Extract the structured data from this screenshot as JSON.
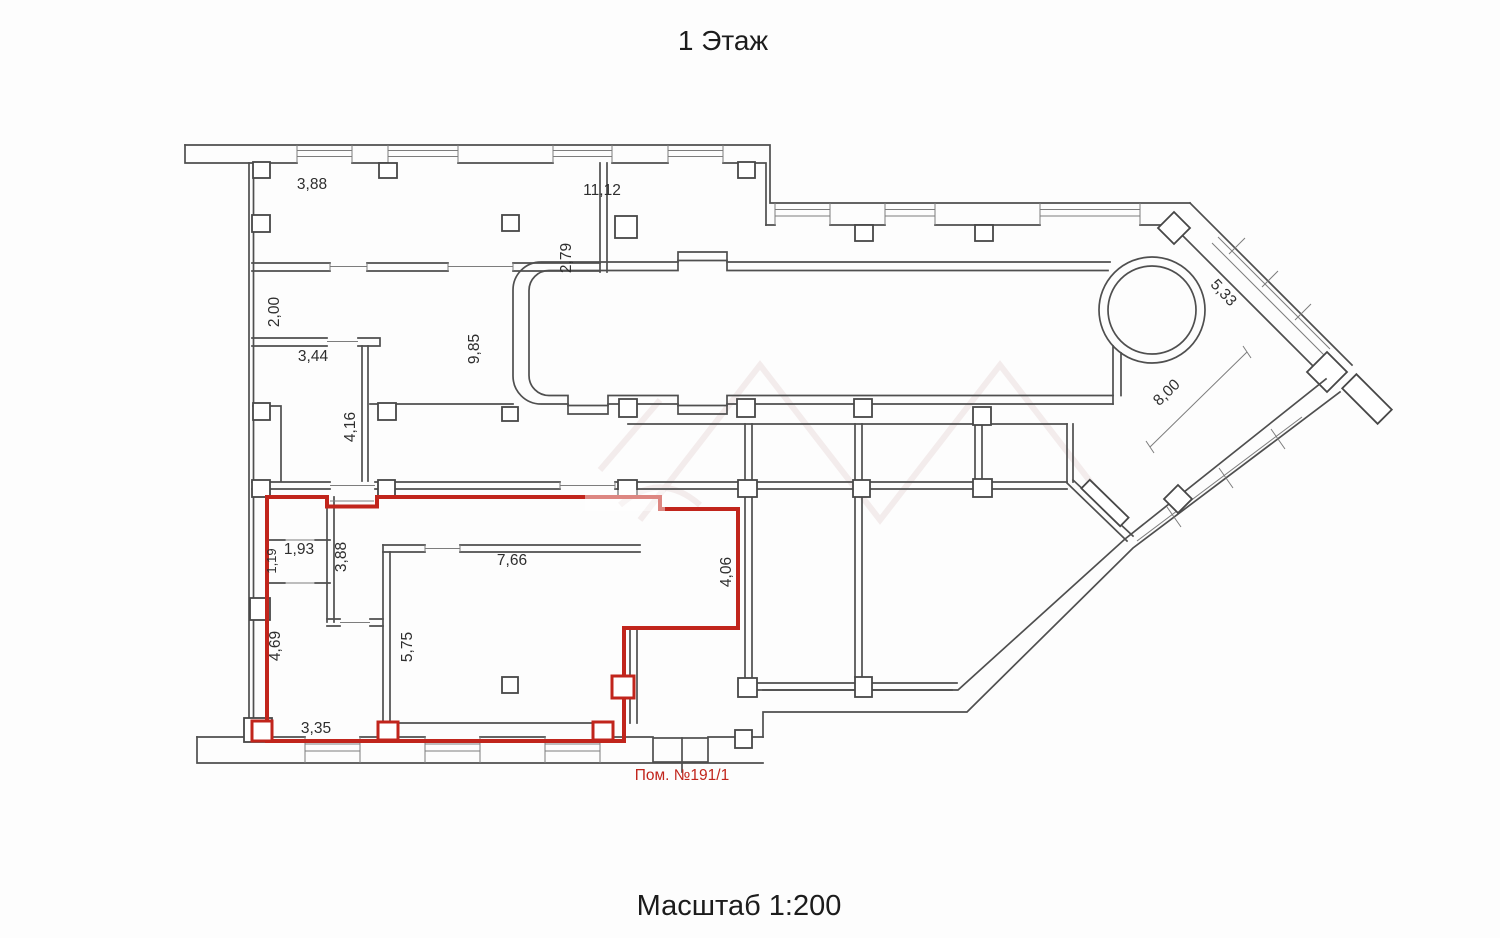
{
  "page": {
    "title": "1 Этаж",
    "scale_label": "Масштаб 1:200"
  },
  "plan": {
    "selected_room_label": "Пом. №191/1",
    "colors": {
      "walls": "#4f4f4f",
      "selection_red": "#c1251c",
      "text": "#2e2e2e"
    },
    "dimensions": {
      "room_a_width": "3,88",
      "hall_top_width": "11,12",
      "room_a_depth": "2,79",
      "corridor_width": "2,00",
      "room_b_width": "3,44",
      "room_b_depth": "4,16",
      "hall_depth": "9,85",
      "diag_facade_window": "5,33",
      "diag_inner_wall": "8,00",
      "closet_depth": "1,19",
      "closet_width": "1,93",
      "inner_wall_depth": "3,88",
      "main_room_width": "7,66",
      "selected_right_depth": "4,06",
      "selected_left_depth": "4,69",
      "main_room_depth": "5,75",
      "selected_bottom_width": "3,35"
    }
  }
}
